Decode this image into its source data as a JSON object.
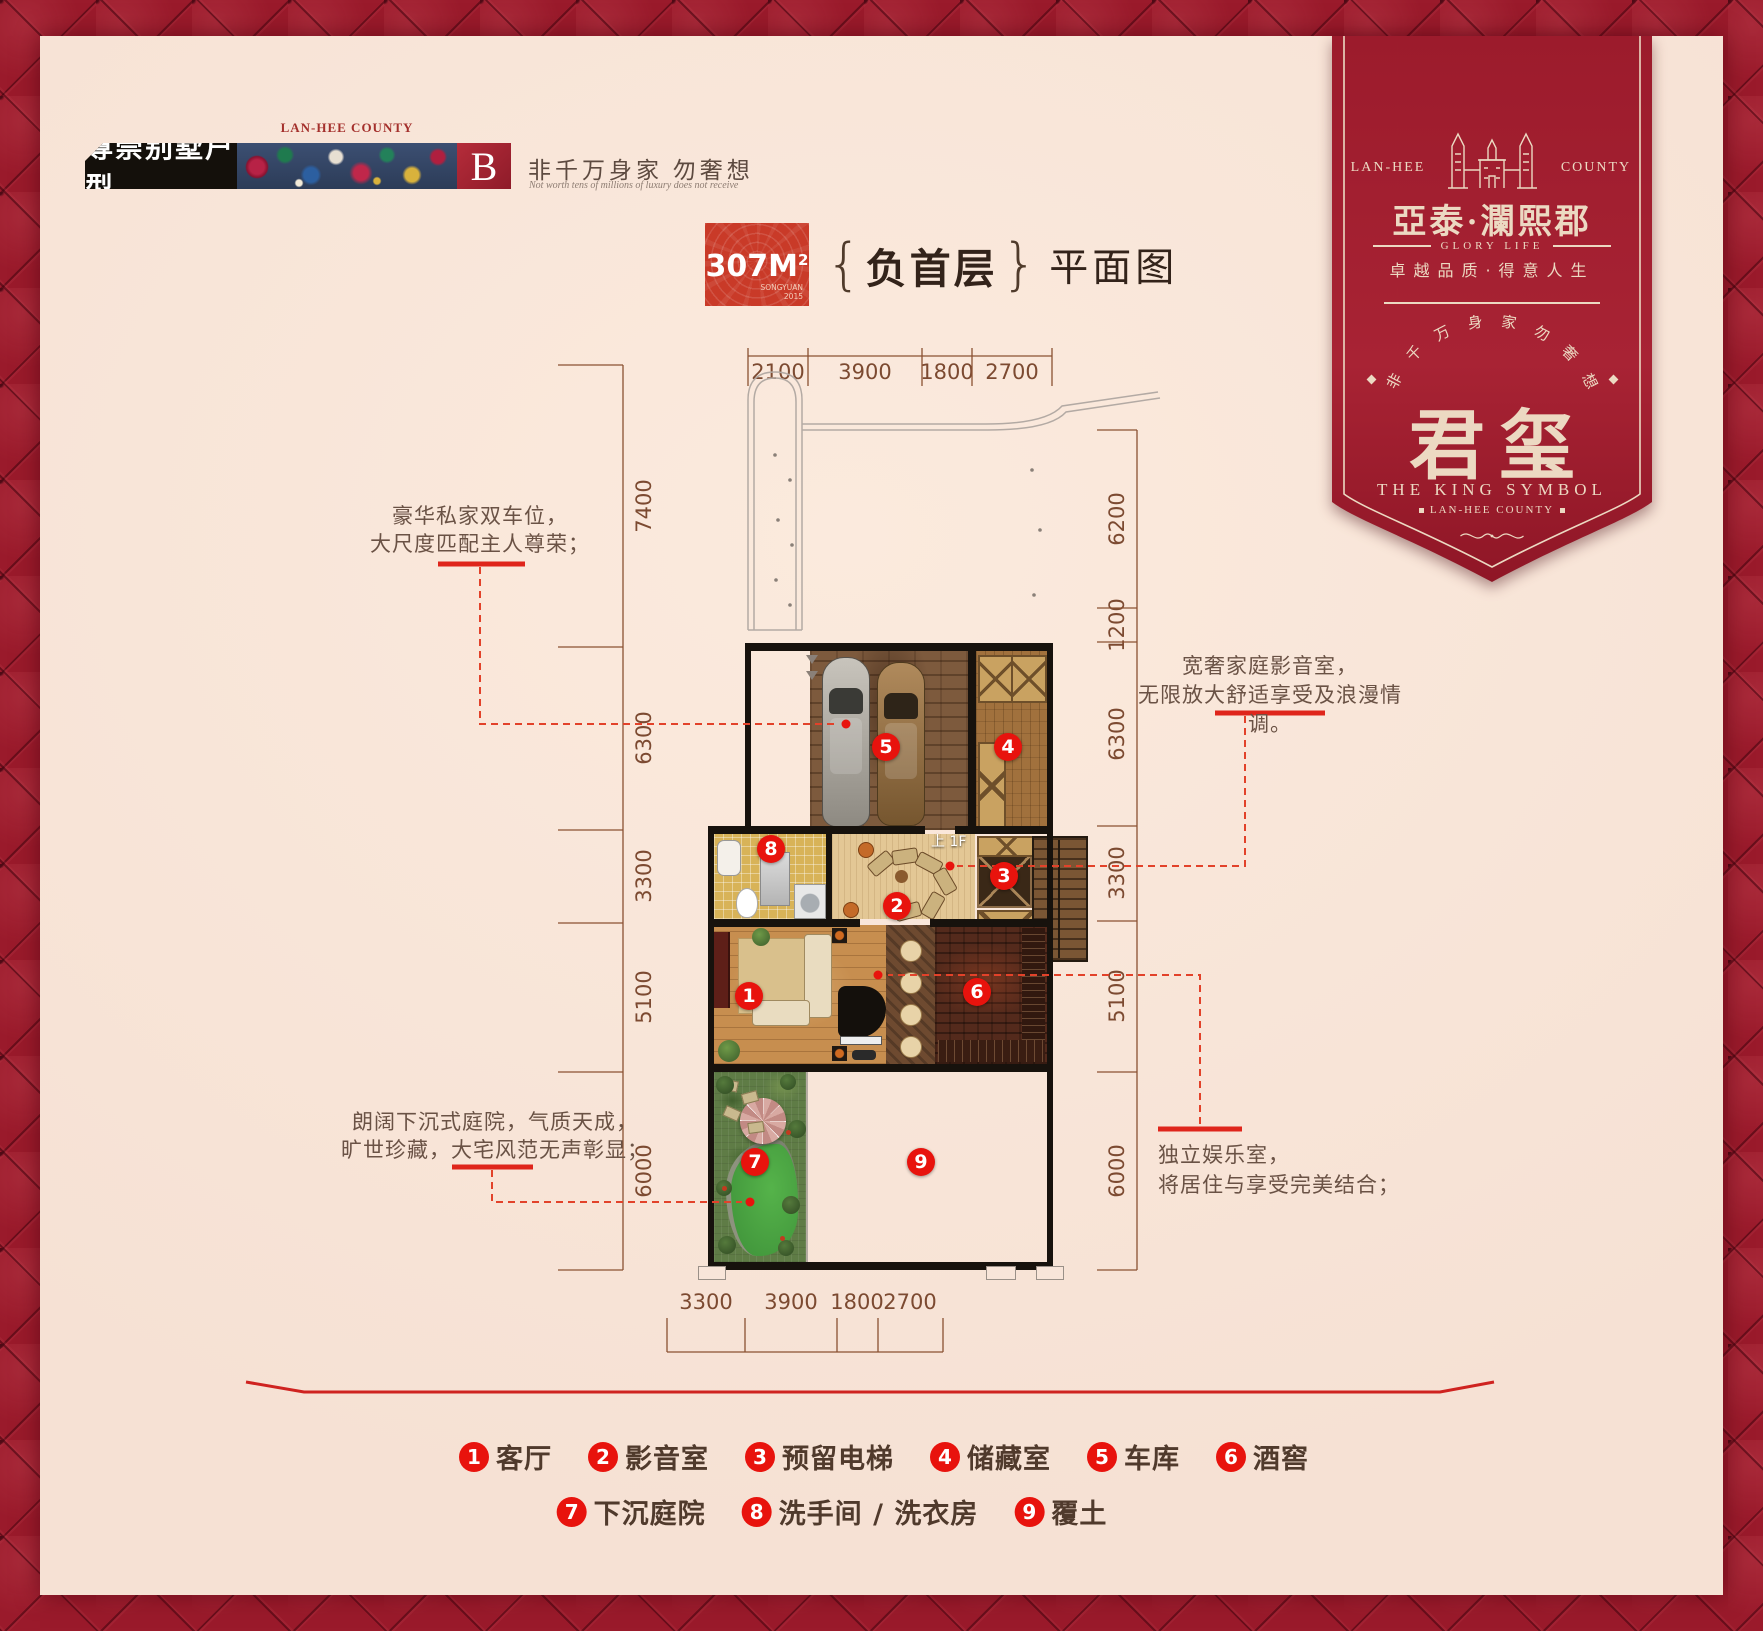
{
  "header": {
    "badge": "尊崇别墅户型",
    "county": "LAN-HEE COUNTY",
    "type_letter": "B",
    "tagline": "非千万身家 勿奢想",
    "tagline_en": "Not worth tens of millions of luxury does not receive"
  },
  "title": {
    "area": "307M",
    "area_sup": "2",
    "area_badge_sub": "SONGYUAN 2015",
    "brace_l": "{",
    "brace_r": "}",
    "floor": "负首层",
    "suffix": "平面图"
  },
  "banner": {
    "county_left": "LAN-HEE",
    "county_right": "COUNTY",
    "brand": "亞泰·瀾熙郡",
    "glory": "GLORY LIFE",
    "slogan": "卓越品质·得意人生",
    "arc_chars": [
      "非",
      "千",
      "万",
      "身",
      "家",
      "勿",
      "奢",
      "想"
    ],
    "logo": "君玺",
    "logo_en": "THE KING SYMBOL",
    "logo_sub": "LAN-HEE COUNTY"
  },
  "plan": {
    "dims_top": [
      "2100",
      "3900",
      "1800",
      "2700"
    ],
    "dims_left": [
      "7400",
      "6300",
      "3300",
      "5100",
      "6000"
    ],
    "dims_right": [
      "6200",
      "1200",
      "6300",
      "3300",
      "5100",
      "6000"
    ],
    "dims_bottom": [
      "3300",
      "3900",
      "1800",
      "2700"
    ],
    "stair_label": "上 1F",
    "room_markers": [
      "1",
      "2",
      "3",
      "4",
      "5",
      "6",
      "7",
      "8",
      "9"
    ]
  },
  "annotations": {
    "garage": [
      "豪华私家双车位，",
      "大尺度匹配主人尊荣；"
    ],
    "media": [
      "宽奢家庭影音室，",
      "无限放大舒适享受及浪漫情调。"
    ],
    "courtyard": [
      "朗阔下沉式庭院，气质天成，",
      "旷世珍藏，大宅风范无声彰显；"
    ],
    "entertainment": [
      "独立娱乐室，",
      "将居住与享受完美结合；"
    ]
  },
  "legend": {
    "row1": [
      {
        "num": "1",
        "label": "客厅"
      },
      {
        "num": "2",
        "label": "影音室"
      },
      {
        "num": "3",
        "label": "预留电梯"
      },
      {
        "num": "4",
        "label": "储藏室"
      },
      {
        "num": "5",
        "label": "车库"
      },
      {
        "num": "6",
        "label": "酒窖"
      }
    ],
    "row2": [
      {
        "num": "7",
        "label": "下沉庭院"
      },
      {
        "num": "8",
        "label": "洗手间 / 洗衣房"
      },
      {
        "num": "9",
        "label": "覆土"
      }
    ]
  },
  "colors": {
    "accent_red": "#e8130d",
    "banner_red": "#a51f31",
    "panel_cream": "#f8e5d9",
    "dim_brown": "#7c4a31",
    "tufted_red": "#9a1a2b"
  }
}
